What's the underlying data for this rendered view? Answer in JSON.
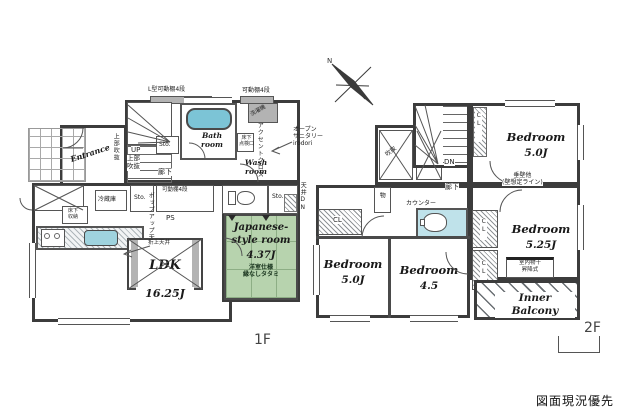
{
  "footer": {
    "note": "図面現況優先"
  },
  "colors": {
    "wall": "#3c3c3c",
    "tatami_green": "#b7d3ae",
    "water_blue": "#9fd3de",
    "bath_blue": "#7cc4d6"
  },
  "floor1": {
    "floor_label": "1F",
    "labels": {
      "shelf_top_left": "L型可動棚4段",
      "shelf_top_right": "可動棚4段",
      "up": "UP",
      "void_stairs": "上部\n吹抜",
      "sto_stairs": "Sto.",
      "bath": "Bath\nroom",
      "wash": "Wash\nroom",
      "accent": "アクセントクロス",
      "washer": "洗濯機",
      "inspection": "床下\n点検口",
      "open_sanitary": "オープン\nサニタリー\nirodori",
      "entrance": "Entrance",
      "void_entrance": "上部吹抜",
      "hall": "廊下",
      "sto_a": "Sto.",
      "shelf_mid": "可動棚4段",
      "sto_b": "Sto.",
      "ceiling_dn": "天井DN",
      "ps": "PS",
      "fridge": "冷蔵庫",
      "floor_storage": "床下\n収納",
      "popup": "ポップアップ天井",
      "raised": "折上天井",
      "ldk": "LDK",
      "ldk_size": "16.25J",
      "jp_name": "Japanese-\nstyle room",
      "jp_size": "4.37J",
      "jp_note": "洋室仕様\n縁なしタタミ"
    }
  },
  "floor2": {
    "floor_label": "2F",
    "labels": {
      "north": "N",
      "void_a": "吹抜",
      "void_b": "吹抜",
      "dn": "DN",
      "cl_top": "CL",
      "cl_left": "CL",
      "cl_mid_upper": "CL",
      "cl_mid_lower": "CL",
      "mono": "物",
      "hall": "廊下",
      "counter": "カウンター",
      "wall_note": "垂壁他\n(壁想定ライン)",
      "drying": "室内物干\n昇降式",
      "balcony": "Inner Balcony"
    },
    "rooms": {
      "top": {
        "name": "Bedroom",
        "size": "5.0J"
      },
      "right": {
        "name": "Bedroom",
        "size": "5.25J"
      },
      "left": {
        "name": "Bedroom",
        "size": "5.0J"
      },
      "mid": {
        "name": "Bedroom",
        "size": "4.5"
      }
    }
  }
}
